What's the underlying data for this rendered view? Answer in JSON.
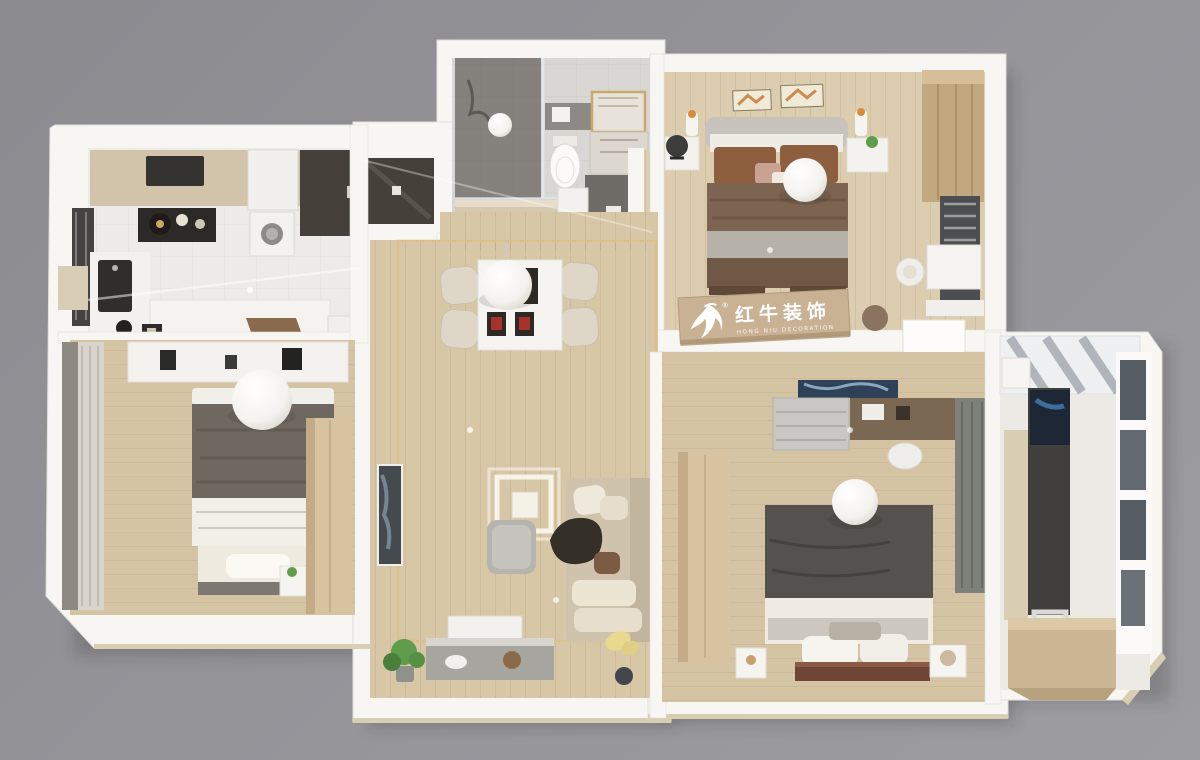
{
  "app": {
    "name": "3d-apartment-floorplan-render",
    "view": "top-down dollhouse render"
  },
  "watermark": {
    "brand_cn": "红牛装饰",
    "brand_en": "HONG NIU DECORATION",
    "registered_mark": "®",
    "logo": "bull-swoosh-icon"
  },
  "palette": {
    "bg1": "#8b8b90",
    "bg2": "#96969b",
    "bg3": "#9d9da1",
    "wall": "#f7f6f3",
    "wallEdge": "#e2dfd9",
    "base": "#d9cdb2",
    "woodLiving": "#d8c7a7",
    "woodMaster": "#dccdb0",
    "woodBed": "#d4c4a4",
    "tile": "#ecebe7",
    "tileBath": "#d9d7d3",
    "gold": "#d9c18b",
    "counter": "#d1c4ab",
    "darkUnit": "#46403a",
    "duvetGray": "#6e6860",
    "duvetDark": "#55514e",
    "duvetBrown": "#7c6450",
    "blanketGray": "#b7b2a9",
    "sofa": "#cfc3ae",
    "cushion": "#ece5d3",
    "sideboard": "#a7a5a0",
    "wardrobeTan": "#d7c3a0",
    "wardrobeMaster": "#c2a87e",
    "curtain": "#8e8a82",
    "curtainGreen": "#7d817a",
    "glass": "#565d64",
    "screenBlue": "#2e4156",
    "banner": "#c9b294",
    "bannerEdge": "#b29a7a",
    "accentRed": "#a8322a",
    "plantGreen": "#5f9c4c",
    "lampYellow": "#e8d98f",
    "artDark": "#454a4e",
    "pillowBrown": "#8d5f3f"
  },
  "rooms": [
    {
      "id": "kitchen",
      "floor": "tile",
      "furniture": [
        "counter-cooktop",
        "coffee-station",
        "fridge",
        "tall-dark-cabinet",
        "washing-machine",
        "sink",
        "dishwasher",
        "peninsula-counter",
        "open-door"
      ]
    },
    {
      "id": "bathroom",
      "floor": "tile",
      "furniture": [
        "walk-in-shower",
        "glass-partition",
        "towel-shelf",
        "toilet",
        "vanity-mirror",
        "vanity-cabinet"
      ]
    },
    {
      "id": "master-bedroom",
      "floor": "wood",
      "furniture": [
        "double-bed",
        "nightstand-left",
        "nightstand-right",
        "table-lamps",
        "wall-frames",
        "wardrobe",
        "window",
        "desk",
        "chair",
        "ceiling-light",
        "office-chair"
      ]
    },
    {
      "id": "left-bedroom",
      "floor": "wood",
      "furniture": [
        "double-bed",
        "foot-bench",
        "nightstand",
        "wardrobe",
        "window-curtains",
        "shelf-desk",
        "ceiling-light"
      ]
    },
    {
      "id": "living-dining",
      "floor": "wood",
      "furniture": [
        "dining-table",
        "dining-chairs",
        "pendant-light",
        "square-ceiling-light",
        "coffee-table",
        "corner-sofa",
        "wall-art",
        "tv-sideboard",
        "screen-panel",
        "floor-lamp",
        "potted-plant",
        "gold-ceiling-trim"
      ]
    },
    {
      "id": "bedroom-2",
      "floor": "wood",
      "furniture": [
        "double-bed",
        "nightstands",
        "headboard-shelf",
        "dresser-desk",
        "tv-panel",
        "stool",
        "wardrobe",
        "curtain",
        "ceiling-light"
      ]
    },
    {
      "id": "balcony-study",
      "floor": "tile",
      "furniture": [
        "skylight",
        "window-wall",
        "desk",
        "monitor",
        "stool",
        "storage-cabinet"
      ]
    }
  ]
}
